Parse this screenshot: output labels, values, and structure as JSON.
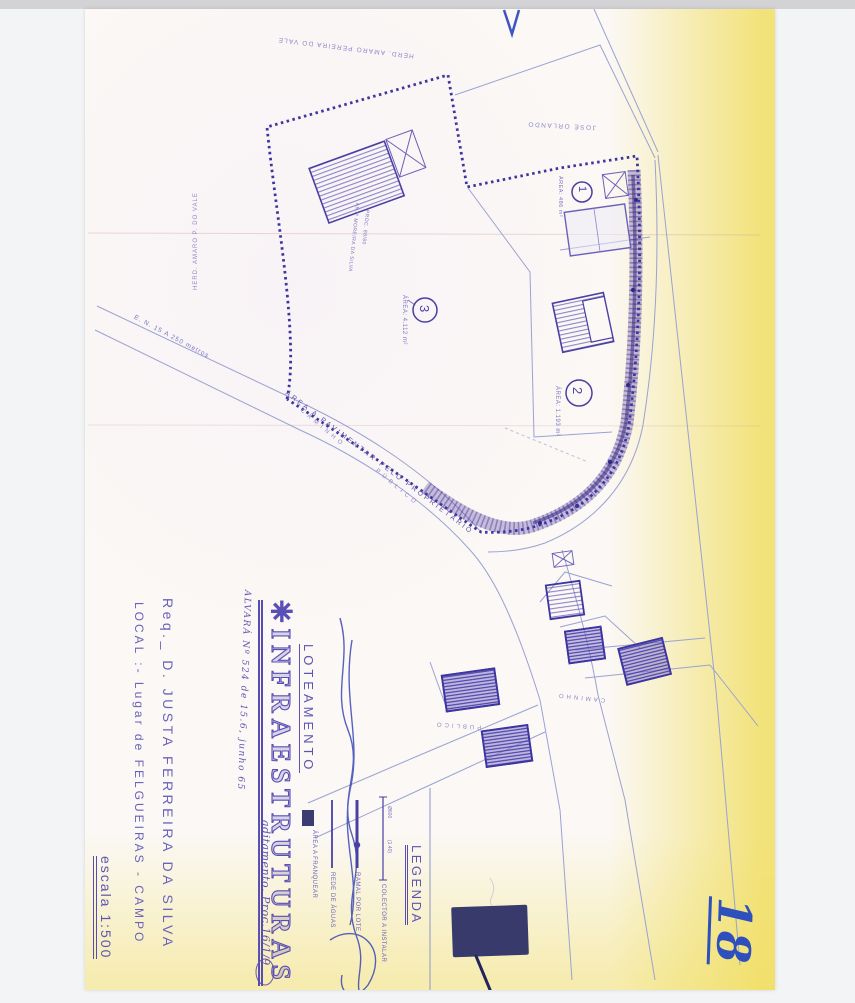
{
  "title_block": {
    "title": "✳INFRAESTRUTURAS",
    "alvara_note": "ALVARÁ Nº 524 de 15.6, junho 65",
    "aditamento_note": "aditamento. Proc.16/1/9",
    "subtitle": "LOTEAMENTO",
    "requerente": "Req._ D. JUSTA FERREIRA DA SILVA",
    "local": "LOCAL :- Lugar de FELGUEIRAS - CAMPO",
    "escala": "escala 1:500"
  },
  "legend": {
    "title": "LEGENDA",
    "entries": [
      {
        "symbol": "thin-line",
        "note1": "Ø600",
        "note2": "(1.40)",
        "label": "COLECTOR A INSTALAR"
      },
      {
        "symbol": "thick-line",
        "label": "RAMAL POR LOTE"
      },
      {
        "symbol": "medium-line",
        "label": "REDE DE ÁGUAS"
      },
      {
        "symbol": "dark-swatch",
        "label": "ÁREA A FRANQUEAR"
      }
    ]
  },
  "plan": {
    "neighbors": {
      "north": "HERD. AMARO PEREIRA DO VALE",
      "west": "HERD. AMARO P. DO VALE",
      "east": "JOSÉ ORLANDO"
    },
    "roads": {
      "en15": "E. N. 15 A 250 metros",
      "pavimentar": "ÁREA A PAVIMENTAR PELO PROPRIETÁRIO",
      "caminho": "CAMINHO",
      "publico": "PÚBLICO"
    },
    "lots": [
      {
        "num": "1",
        "area": "ÁREA: 486 m²"
      },
      {
        "num": "2",
        "area": "ÁREA: 1.193 m²"
      },
      {
        "num": "3",
        "area": "ÁREA: 4.112 m²"
      }
    ],
    "building_note1": "ANTº MOREIRA DA SILVA",
    "building_note2": "PROC. 88/80"
  },
  "annotations": {
    "sheet_number": "18"
  },
  "colors": {
    "ink": "#4a3fa5",
    "light_line": "#9aa2d2",
    "stamp": "#383a6b",
    "pen": "#2d50bd"
  }
}
